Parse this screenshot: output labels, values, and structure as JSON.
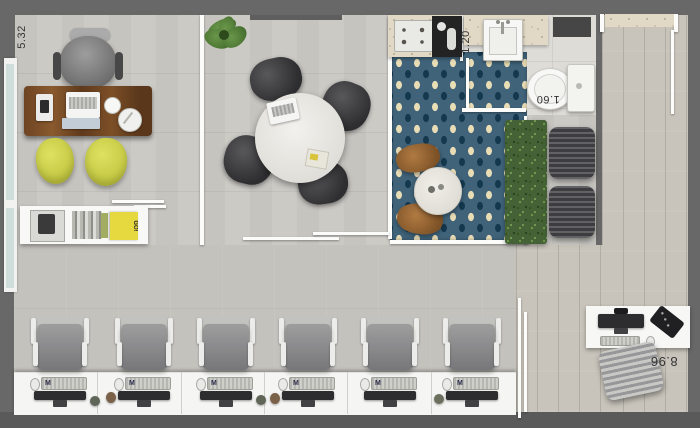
{
  "dimensions": {
    "room_width": "5.32",
    "bath_width": "1.20",
    "bath_length": "1.60",
    "plan_width": "8.96"
  },
  "decor": {
    "book_box_text": "GO!",
    "keyboard_logo": "M"
  },
  "palette": {
    "outer_wall": "#6c6c6c",
    "inner_wall": "#fcfcfb",
    "concrete_floor": "#cac8c3",
    "wood_floor": "#c8c4bb",
    "rug_teal": "#40637a",
    "rug_sand": "#e9ddb6",
    "desk_wood": "#6f4724",
    "accent_chair_yellow": "#d3d655",
    "hedge_green": "#446236",
    "dark_furniture": "#3d3d40"
  }
}
